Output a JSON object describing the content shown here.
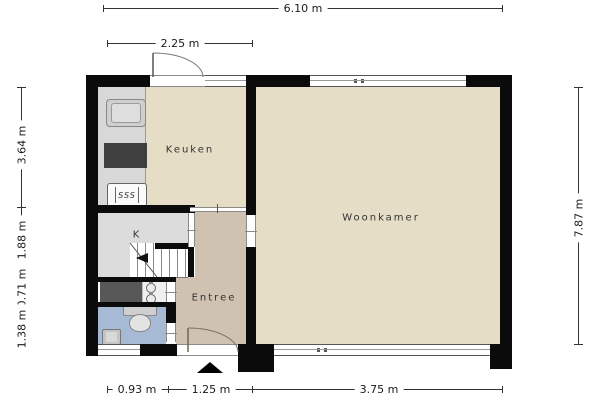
{
  "plan": {
    "type": "floorplan",
    "language": "nl",
    "rooms": {
      "keuken": "Keuken",
      "woonkamer": "Woonkamer",
      "entree": "Entree",
      "closet": "K"
    },
    "dimensions": {
      "top_total": "6.10 m",
      "kitchen_width": "2.25 m",
      "left_kitchen": "3.64 m",
      "left_closet": "1.88 m",
      "left_meter": "0.71 m",
      "left_toilet": "1.38 m",
      "right_total": "7.87 m",
      "bottom_toilet": "0.93 m",
      "bottom_entrance": "1.25 m",
      "bottom_livingroom": "3.75 m"
    },
    "icons": {
      "boiler_label": "SSS"
    },
    "colors": {
      "wall": "#0b0b0b",
      "floor_main": "#e6ddc7",
      "floor_entree": "#cfc2b1",
      "floor_toilet": "#a6bad5",
      "floor_closet": "#dcdcdc",
      "counter": "#d8d8d8",
      "meter_cabinet": "#575757"
    }
  }
}
